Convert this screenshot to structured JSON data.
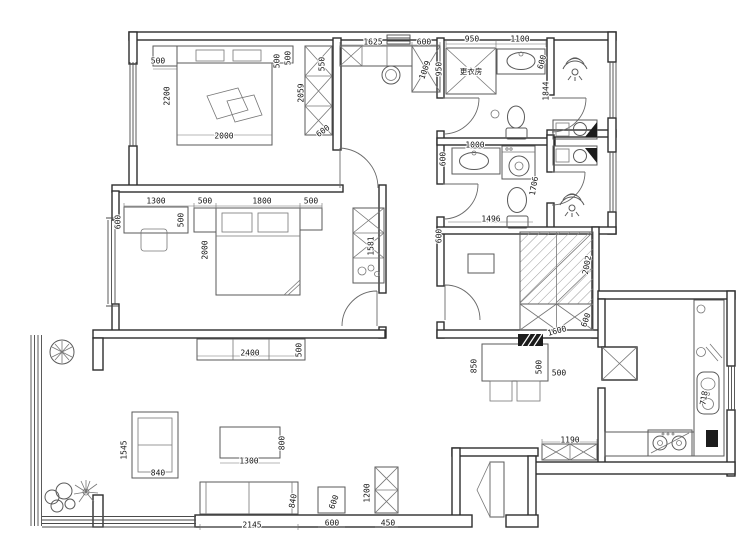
{
  "plan": {
    "type": "apartment-floor-plan",
    "colors": {
      "wall": "#2e2e2e",
      "furniture": "#5a5a5a",
      "dimension_text": "#141414",
      "background": "#ffffff"
    },
    "room_labels": [
      {
        "text": "更衣房",
        "x": 471,
        "y": 72
      }
    ],
    "dimensions": [
      {
        "text": "500",
        "x": 158,
        "y": 61,
        "r": 0
      },
      {
        "text": "2200",
        "x": 167,
        "y": 96,
        "r": -90
      },
      {
        "text": "2000",
        "x": 224,
        "y": 136,
        "r": 0
      },
      {
        "text": "500",
        "x": 277,
        "y": 61,
        "r": -90
      },
      {
        "text": "500",
        "x": 288,
        "y": 58,
        "r": -90
      },
      {
        "text": "550",
        "x": 322,
        "y": 64,
        "r": -90
      },
      {
        "text": "2059",
        "x": 301,
        "y": 93,
        "r": -90
      },
      {
        "text": "600",
        "x": 323,
        "y": 131,
        "r": -35
      },
      {
        "text": "1625",
        "x": 373,
        "y": 42,
        "r": 0
      },
      {
        "text": "600",
        "x": 424,
        "y": 42,
        "r": 0
      },
      {
        "text": "1009",
        "x": 425,
        "y": 70,
        "r": -70
      },
      {
        "text": "950",
        "x": 439,
        "y": 69,
        "r": -90
      },
      {
        "text": "950",
        "x": 472,
        "y": 39,
        "r": 0
      },
      {
        "text": "1100",
        "x": 520,
        "y": 39,
        "r": 0
      },
      {
        "text": "600",
        "x": 542,
        "y": 62,
        "r": -75
      },
      {
        "text": "1844",
        "x": 546,
        "y": 91,
        "r": -90
      },
      {
        "text": "1000",
        "x": 475,
        "y": 145,
        "r": 0
      },
      {
        "text": "600",
        "x": 443,
        "y": 159,
        "r": -90
      },
      {
        "text": "1706",
        "x": 534,
        "y": 186,
        "r": -80
      },
      {
        "text": "1496",
        "x": 491,
        "y": 219,
        "r": 0
      },
      {
        "text": "600",
        "x": 439,
        "y": 236,
        "r": -90
      },
      {
        "text": "2002",
        "x": 587,
        "y": 265,
        "r": -80
      },
      {
        "text": "1600",
        "x": 557,
        "y": 331,
        "r": -15
      },
      {
        "text": "600",
        "x": 586,
        "y": 320,
        "r": -70
      },
      {
        "text": "1300",
        "x": 156,
        "y": 201,
        "r": 0
      },
      {
        "text": "500",
        "x": 205,
        "y": 201,
        "r": 0
      },
      {
        "text": "1800",
        "x": 262,
        "y": 201,
        "r": 0
      },
      {
        "text": "500",
        "x": 311,
        "y": 201,
        "r": 0
      },
      {
        "text": "600",
        "x": 118,
        "y": 222,
        "r": -90
      },
      {
        "text": "500",
        "x": 181,
        "y": 220,
        "r": -90
      },
      {
        "text": "2000",
        "x": 205,
        "y": 250,
        "r": -90
      },
      {
        "text": "1581",
        "x": 371,
        "y": 246,
        "r": -90
      },
      {
        "text": "2400",
        "x": 250,
        "y": 353,
        "r": 0
      },
      {
        "text": "500",
        "x": 299,
        "y": 350,
        "r": -90
      },
      {
        "text": "1545",
        "x": 124,
        "y": 450,
        "r": -90
      },
      {
        "text": "840",
        "x": 158,
        "y": 473,
        "r": 0
      },
      {
        "text": "1300",
        "x": 249,
        "y": 461,
        "r": 0
      },
      {
        "text": "800",
        "x": 282,
        "y": 443,
        "r": -90
      },
      {
        "text": "2145",
        "x": 252,
        "y": 525,
        "r": 0
      },
      {
        "text": "840",
        "x": 293,
        "y": 501,
        "r": -80
      },
      {
        "text": "600",
        "x": 334,
        "y": 502,
        "r": -70
      },
      {
        "text": "600",
        "x": 332,
        "y": 523,
        "r": 0
      },
      {
        "text": "1200",
        "x": 367,
        "y": 493,
        "r": -90
      },
      {
        "text": "450",
        "x": 388,
        "y": 523,
        "r": 0
      },
      {
        "text": "850",
        "x": 474,
        "y": 366,
        "r": -90
      },
      {
        "text": "500",
        "x": 539,
        "y": 367,
        "r": -90
      },
      {
        "text": "500",
        "x": 559,
        "y": 373,
        "r": 0
      },
      {
        "text": "1190",
        "x": 570,
        "y": 440,
        "r": 0
      },
      {
        "text": "718",
        "x": 704,
        "y": 398,
        "r": -80
      }
    ]
  }
}
